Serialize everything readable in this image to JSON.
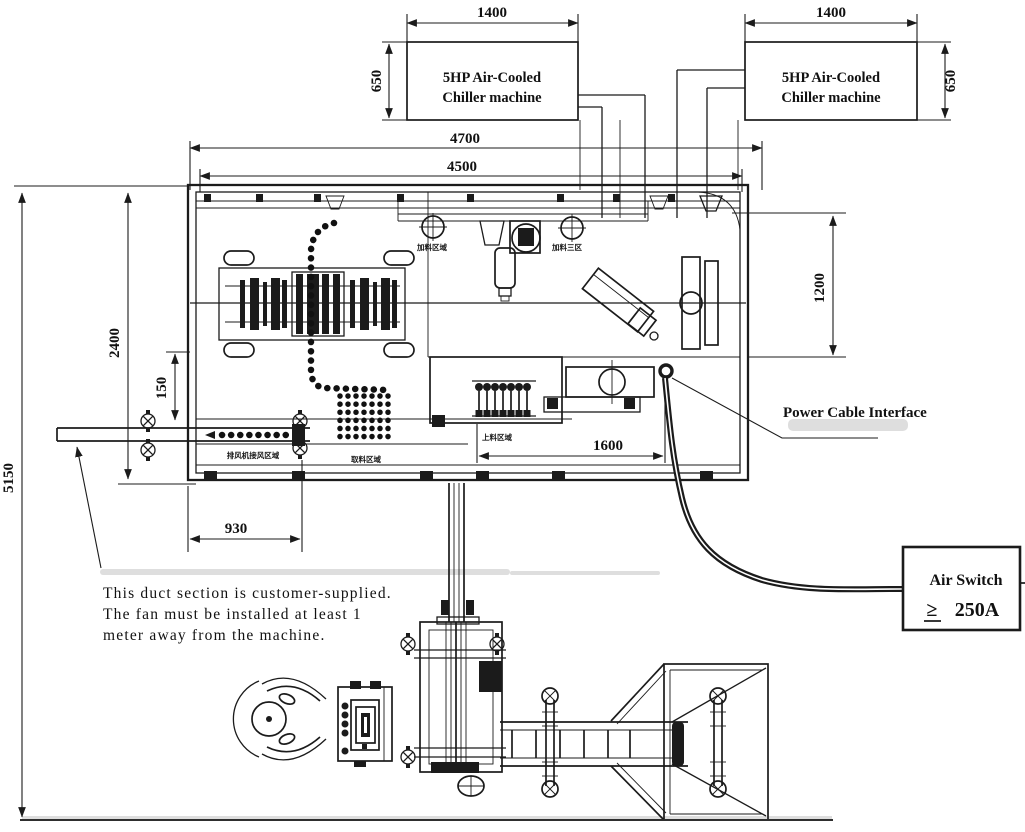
{
  "chillers": {
    "left": {
      "label_line1": "5HP Air-Cooled",
      "label_line2": "Chiller machine",
      "width_dim": "1400",
      "height_dim": "650"
    },
    "right": {
      "label_line1": "5HP Air-Cooled",
      "label_line2": "Chiller machine",
      "width_dim": "1400",
      "height_dim": "650"
    }
  },
  "dimensions": {
    "overall_width": "4700",
    "machine_width": "4500",
    "machine_depth": "2400",
    "overall_length": "5150",
    "duct_offset": "150",
    "exhaust_section_width": "930",
    "takeout_width": "1600",
    "right_bay_depth": "1200"
  },
  "labels": {
    "power_cable": "Power Cable Interface",
    "air_switch_line1": "Air Switch",
    "air_switch_symbol": "≥",
    "air_switch_line2": "250A",
    "note_line1": "This duct section is customer-supplied.",
    "note_line2": "The fan must be installed at least 1",
    "note_line3": "meter away from the machine.",
    "area_feed_left": "加料区域",
    "area_feed_right": "加料三区",
    "area_loading": "上料区域",
    "area_exhaust": "排风机接风区域",
    "area_takeout": "取料区域"
  }
}
